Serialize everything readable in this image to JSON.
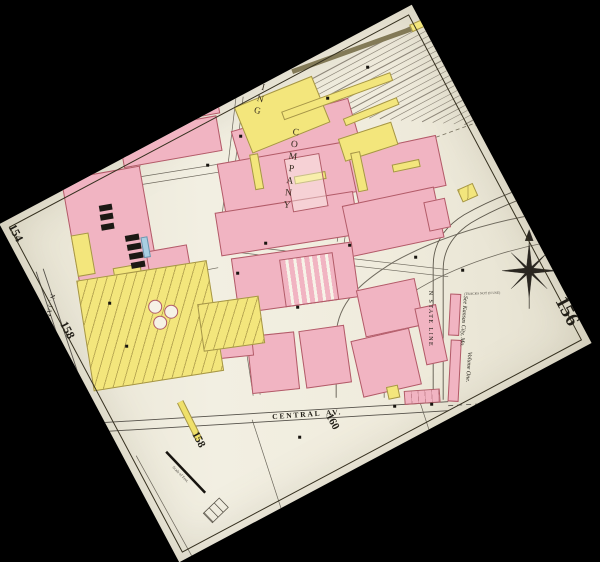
{
  "sheet": {
    "numbers": {
      "left_top": "154",
      "left_mid": "158",
      "right": "156",
      "bottom_left": "158",
      "bottom_right": "160"
    },
    "streets": {
      "central": "CENTRAL",
      "central_av": "AV.",
      "n_james": "N. JAMES",
      "n_state_line": "N STATE LINE"
    },
    "labels": {
      "company_top": "ING",
      "company": "COMPANY",
      "volume_note_1": "See Kansas City, Mo.",
      "volume_note_2": "Volume One.",
      "tracks_note": "(TRACKS NOT IN USE)",
      "scale_label": "Scale of Feet."
    },
    "colors": {
      "paper": "#f0ecdf",
      "building_pink": "#f1b4c2",
      "building_pink_border": "#b25b68",
      "building_yellow": "#f3e67c",
      "building_yellow_border": "#a59547",
      "stone_blue": "#a9cfe2",
      "ink": "#211e17",
      "rail_line": "#8d8679"
    }
  }
}
